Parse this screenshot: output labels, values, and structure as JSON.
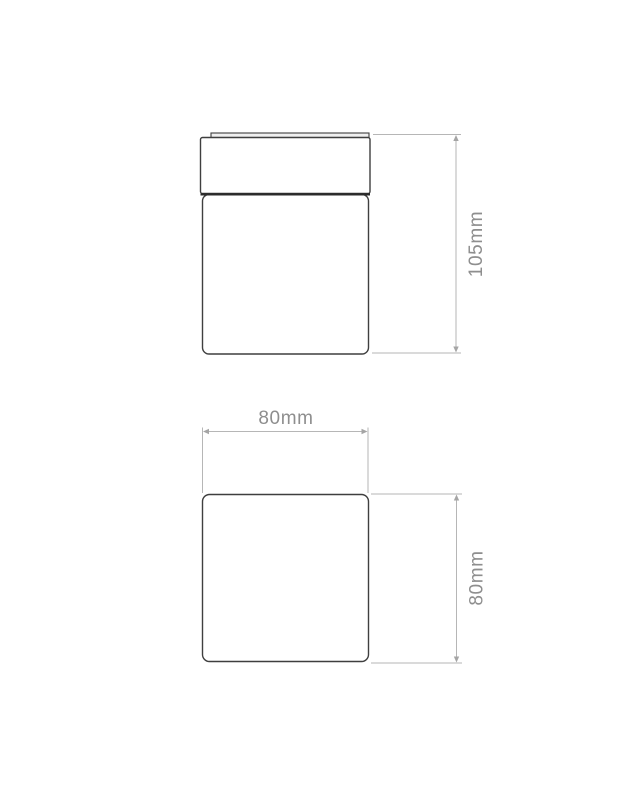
{
  "canvas": {
    "width": 640,
    "height": 800,
    "background": "#ffffff"
  },
  "diagram": {
    "type": "product-dimension-drawing",
    "colors": {
      "outline": "#3f3f3f",
      "outline_heavy": "#2b2b2b",
      "plate_fill": "#f0f0f0",
      "dimension_line": "#b6b6b6",
      "arrow": "#a5a5a5",
      "label_text": "#8e8e8e"
    },
    "views": [
      {
        "id": "side-view",
        "description": "side elevation of square ceiling light with cap and body",
        "dimensions": [
          {
            "id": "height",
            "label": "105mm",
            "orientation": "vertical"
          }
        ]
      },
      {
        "id": "plan-view",
        "description": "plan view square outline",
        "dimensions": [
          {
            "id": "width",
            "label": "80mm",
            "orientation": "horizontal"
          },
          {
            "id": "depth",
            "label": "80mm",
            "orientation": "vertical"
          }
        ]
      }
    ]
  }
}
